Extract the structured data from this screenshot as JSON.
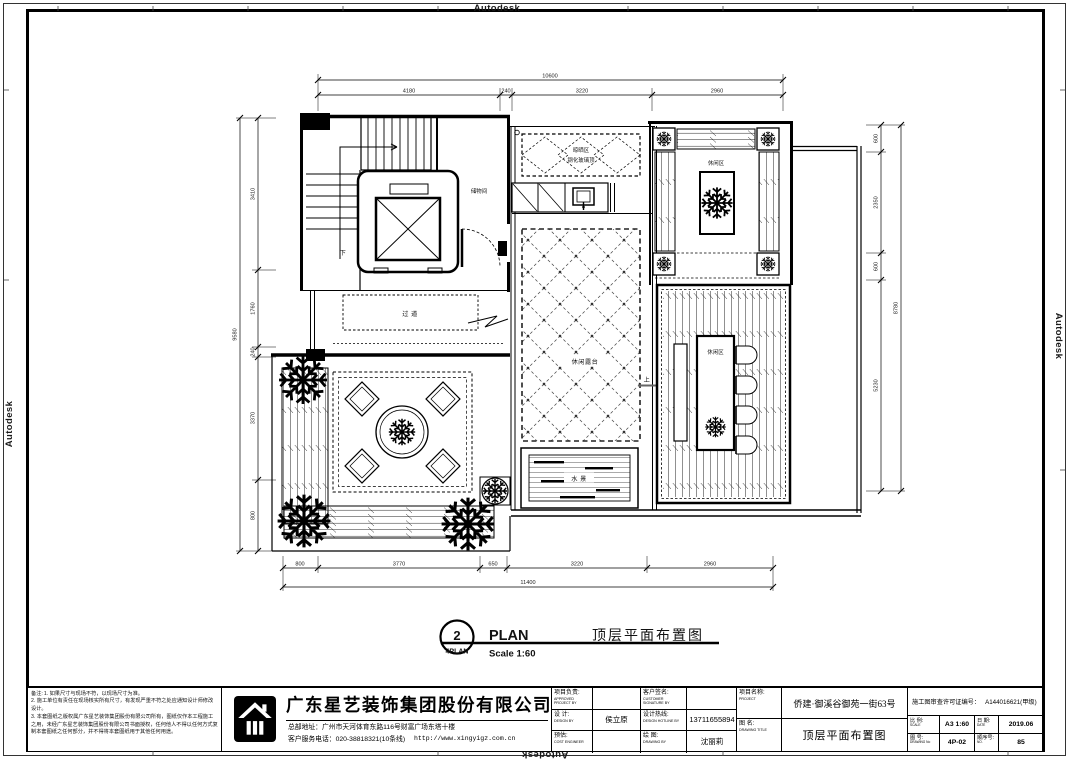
{
  "watermark": "Autodesk",
  "plan": {
    "rooms": {
      "storage": "储物间",
      "down": "下",
      "up": "上",
      "corridor": "过 道",
      "skylight1": "晾晒区",
      "skylight2": "钢化玻璃顶",
      "terrace": "休闲露台",
      "leisure_top": "休闲区",
      "leisure_right": "休闲区",
      "water": "水 景"
    },
    "dims": {
      "top_total": "10600",
      "top": [
        "4180",
        "240",
        "3220",
        "2960"
      ],
      "bottom": [
        "800",
        "3770",
        "650",
        "3220",
        "2960"
      ],
      "bottom_total": "11400",
      "left": [
        "3410",
        "1760",
        "240",
        "3370",
        "800"
      ],
      "left_total": "9580",
      "right": [
        "600",
        "2350",
        "600",
        "5230"
      ],
      "right_total": "8780"
    }
  },
  "plan_title": {
    "number": "2",
    "sheet": "4PLAN",
    "label": "PLAN",
    "scale": "Scale 1:60",
    "name": "顶层平面布置图"
  },
  "titleblock": {
    "notes_label": "备注:",
    "notes": [
      "1. 如果尺寸与现场不符，以现场尺寸为准。",
      "2. 施工单位有责任在现场核实所有尺寸，有发现严重不符之处应通知设计师修改设计。",
      "3. 本套图纸之版权属广东星艺装饰集团股份有限公司所有，图纸仅作本工程施工之用，未经广东星艺装饰集团股份有限公司书面授权，任何他人不得以任何方式复制本套图纸之任何部分，并不得将本套图纸用于其他任何用途。"
    ],
    "company": {
      "name": "广东星艺装饰集团股份有限公司",
      "address": "总部地址：广州市天河体育东路116号财富广场东塔十楼",
      "phone": "客户服务电话：020-38818321(10条线)",
      "website": "http://www.xingyigz.com.cn"
    },
    "personnel": {
      "r1c1z": "项目负责:",
      "r1c1e": "APPROVED PROJECT BY",
      "r1v1": "",
      "r1c2z": "客户签名:",
      "r1c2e": "CUSTOMER SIGNATURE BY",
      "r1v2": "",
      "r2c1z": "设 计:",
      "r2c1e": "DESIGN BY",
      "r2v1": "侯立原",
      "r2c2z": "设计热线:",
      "r2c2e": "DESIGN HOTLINE BY",
      "r2v2": "13711655894",
      "r3c1z": "预估:",
      "r3c1e": "COST ENGINEER",
      "r3v1": "",
      "r3c2z": "绘 图:",
      "r3c2e": "DRAWING BY",
      "r3v2": "沈丽莉"
    },
    "project": {
      "label_z": "项目名称:",
      "label_e": "PROJECT",
      "value": "侨建·御溪谷御苑一街63号",
      "drawing_z": "图 名:",
      "drawing_e": "DRAWING TITLE",
      "drawing_value": "顶层平面布置图"
    },
    "license": {
      "label": "施工图审查许可证编号：",
      "value": "A144016621(甲级)"
    },
    "meta": {
      "scale_z": "比 例:",
      "scale_e": "SCALE",
      "scale_v": "A3 1:60",
      "date_z": "日 期:",
      "date_e": "DATE",
      "date_v": "2019.06",
      "no_z": "图 号:",
      "no_e": "DRAWING No",
      "no_v": "4P-02",
      "seq_z": "顺序号:",
      "seq_e": "NO.",
      "seq_v": "85"
    }
  }
}
